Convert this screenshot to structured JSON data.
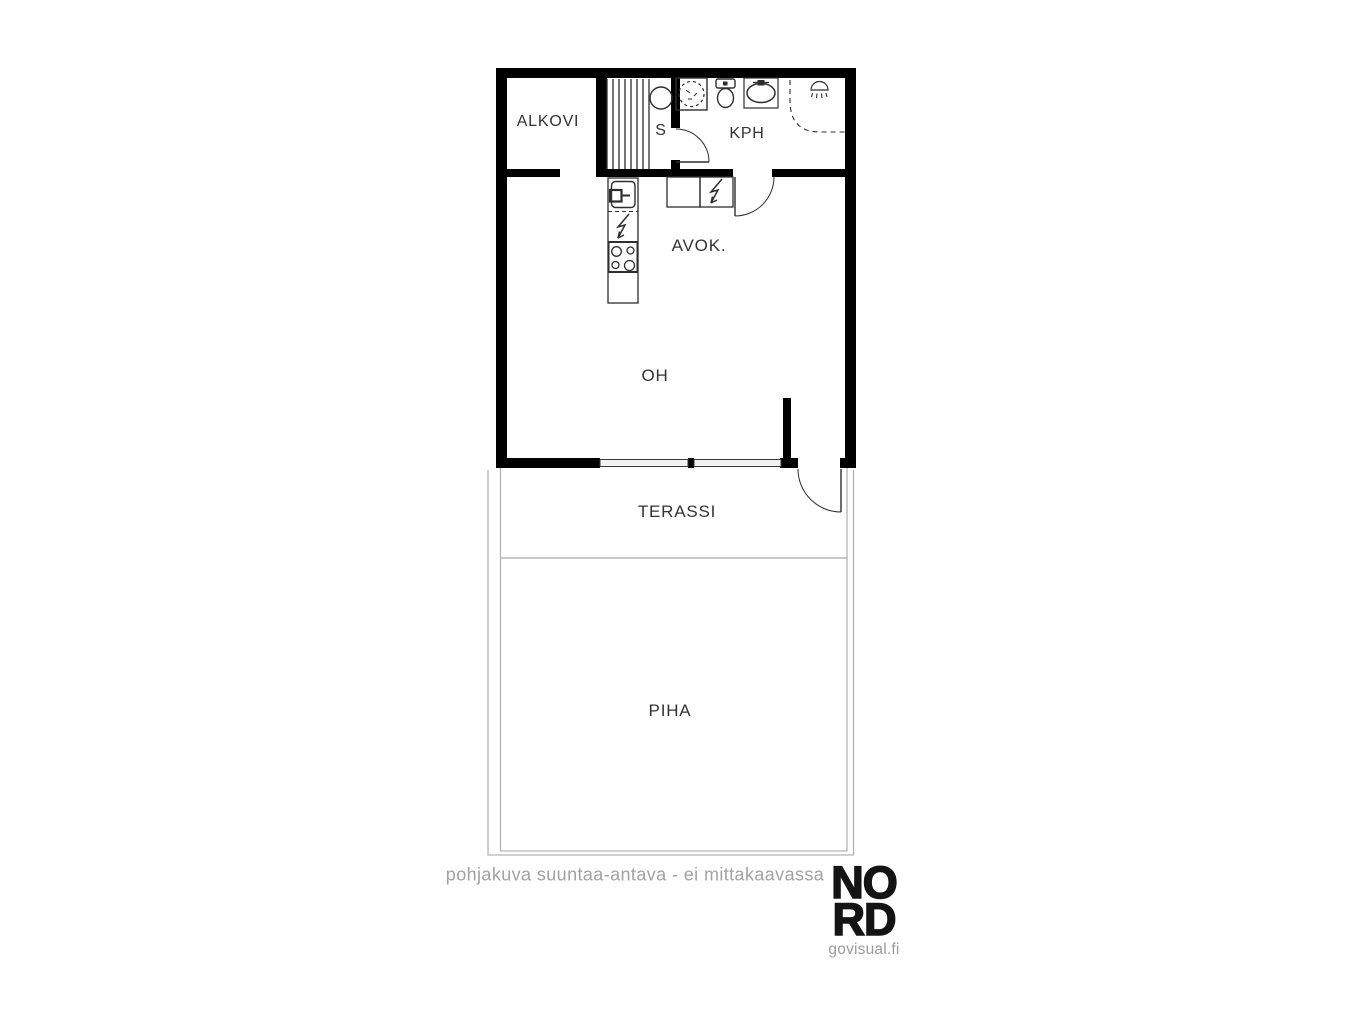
{
  "rooms": {
    "alkovi": {
      "label": "ALKOVI"
    },
    "sauna": {
      "label": "S"
    },
    "kph": {
      "label": "KPH"
    },
    "avok": {
      "label": "AVOK."
    },
    "oh": {
      "label": "OH"
    },
    "terassi": {
      "label": "TERASSI"
    },
    "piha": {
      "label": "PIHA"
    }
  },
  "footer": {
    "disclaimer": "pohjakuva suuntaa-antava - ei mittakaavassa"
  },
  "brand": {
    "line1": "NO",
    "line2": "RD",
    "site": "govisual.fi"
  },
  "icons": {
    "washing-machine-icon": "square with dashed drum circle",
    "toilet-icon": "tank and bowl",
    "bathroom-sink-icon": "square with oval basin and tap",
    "shower-icon": "shower rose with dashed enclosure",
    "sauna-heater-icon": "circle",
    "sauna-benches": "vertical slats",
    "kitchen-sink-icon": "basin with tap",
    "dishwasher-icon": "lightning bolt",
    "stove-icon": "four burners",
    "fridge-icon": "cabinet with lightning bolt"
  },
  "colors": {
    "wall": "#000000",
    "fixture_line": "#2e2e2e",
    "label_text": "#333333",
    "muted_text": "#a2a2a2",
    "yard_line": "#b3b3b3",
    "logo": "#141414"
  }
}
